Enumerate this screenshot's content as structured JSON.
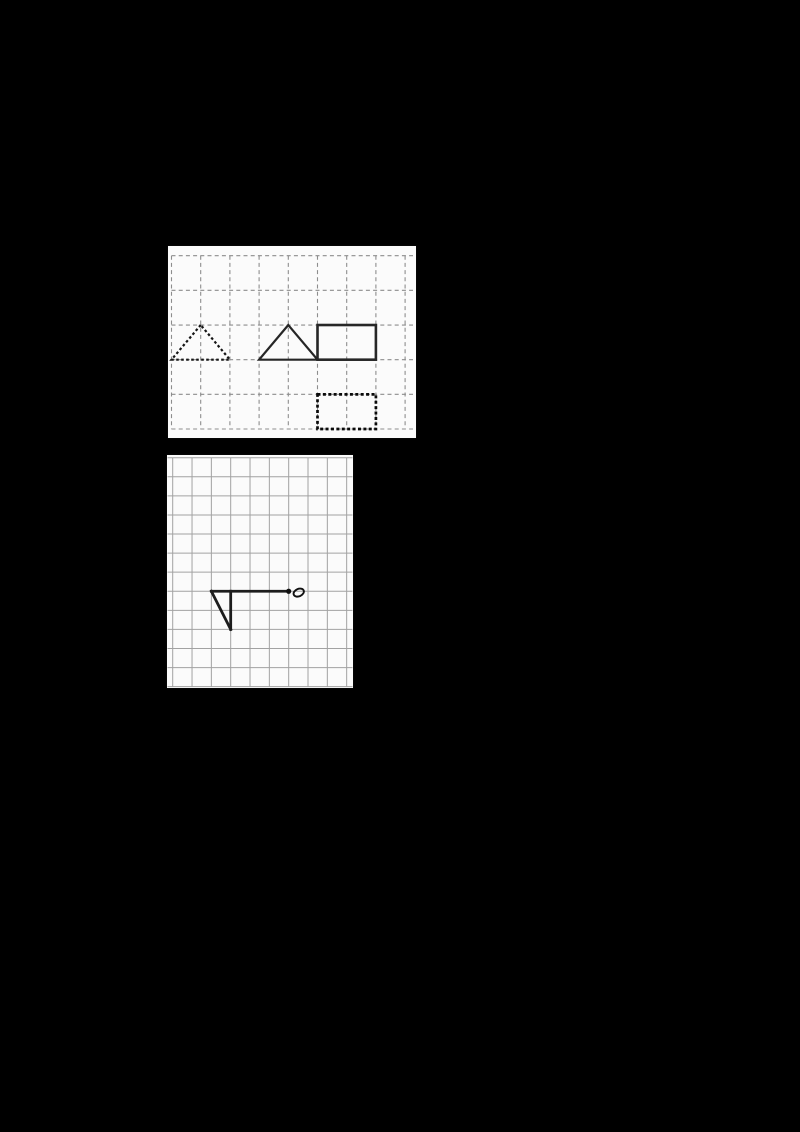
{
  "page": {
    "background": "#000000",
    "width": 800,
    "height": 1132
  },
  "colors": {
    "panel_background": "#fbfbfb",
    "dashed_grid_line": "#8d8d8d",
    "solid_grid_line": "#a2a2a2",
    "figure_stroke": "#1d1d1d"
  },
  "panels": [
    {
      "id": "reference-grid",
      "description_name": "dashed-grid-with-shapes",
      "background": "#fbfbfb",
      "frame": {
        "x": 168,
        "y": 246,
        "w": 248,
        "h": 192
      },
      "grid": {
        "style": "dashed",
        "dash": "4 3.2",
        "line_width": 1.1,
        "color": "#8d8d8d",
        "x_start": 3.5,
        "x_step": 29.2,
        "cols": 9,
        "y_start": 9.7,
        "y_step": 34.66,
        "rows": 6,
        "v_extent": [
          9.7,
          183.1
        ],
        "h_extent": [
          3.5,
          245
        ]
      },
      "shapes": [
        {
          "type": "polygon",
          "name": "dashed-triangle",
          "color": "#151515",
          "width": 2.2,
          "dash": "2.6 2.4",
          "points": [
            [
              1,
              2
            ],
            [
              0,
              3
            ],
            [
              2,
              3
            ]
          ]
        },
        {
          "type": "polygon",
          "name": "solid-triangle",
          "color": "#262626",
          "width": 2.2,
          "points": [
            [
              4,
              2
            ],
            [
              3,
              3
            ],
            [
              5,
              3
            ]
          ]
        },
        {
          "type": "rect",
          "name": "solid-rectangle",
          "color": "#262626",
          "width": 2.6,
          "from": [
            5,
            2
          ],
          "to": [
            7,
            3
          ]
        },
        {
          "type": "rect",
          "name": "bold-dashed-rectangle",
          "color": "#0a0a0a",
          "width": 2.7,
          "dash": "3 2.4",
          "from": [
            5,
            4
          ],
          "to": [
            7,
            5
          ]
        }
      ]
    },
    {
      "id": "drawing-grid",
      "description_name": "solid-grid-with-flag-figure",
      "background": "#fbfbfb",
      "frame": {
        "x": 167,
        "y": 455,
        "w": 186,
        "h": 233
      },
      "grid": {
        "style": "solid",
        "dash": null,
        "line_width": 1,
        "color": "#a2a2a2",
        "x_start": 5.7,
        "x_step": 19.33,
        "cols": 10,
        "y_start": 2.7,
        "y_step": 19.08,
        "rows": 13,
        "v_extent": [
          2.7,
          231.7
        ],
        "h_extent": [
          0.5,
          185.5
        ]
      },
      "shapes": [
        {
          "type": "line",
          "name": "flag-pole-line",
          "color": "#1d1d1d",
          "width": 2.8,
          "cap": "square",
          "from": [
            2,
            7
          ],
          "to": [
            6,
            7
          ]
        },
        {
          "type": "line",
          "name": "flag-vertical-edge",
          "color": "#1d1d1d",
          "width": 2.8,
          "cap": "square",
          "from": [
            3,
            7
          ],
          "to": [
            3,
            9
          ]
        },
        {
          "type": "line",
          "name": "flag-diagonal-edge",
          "color": "#1d1d1d",
          "width": 2.8,
          "cap": "square",
          "from": [
            2,
            7
          ],
          "to": [
            3,
            9
          ]
        },
        {
          "type": "dot",
          "name": "rotation-point-dot",
          "color": "#111111",
          "r": 2.6,
          "at": [
            6,
            7
          ]
        },
        {
          "type": "ellipse",
          "name": "small-o-mark",
          "color": "#111111",
          "width": 1.9,
          "at": [
            6.52,
            7.07
          ],
          "rx": 5.4,
          "ry": 3.7,
          "rotate": -24
        }
      ]
    }
  ]
}
